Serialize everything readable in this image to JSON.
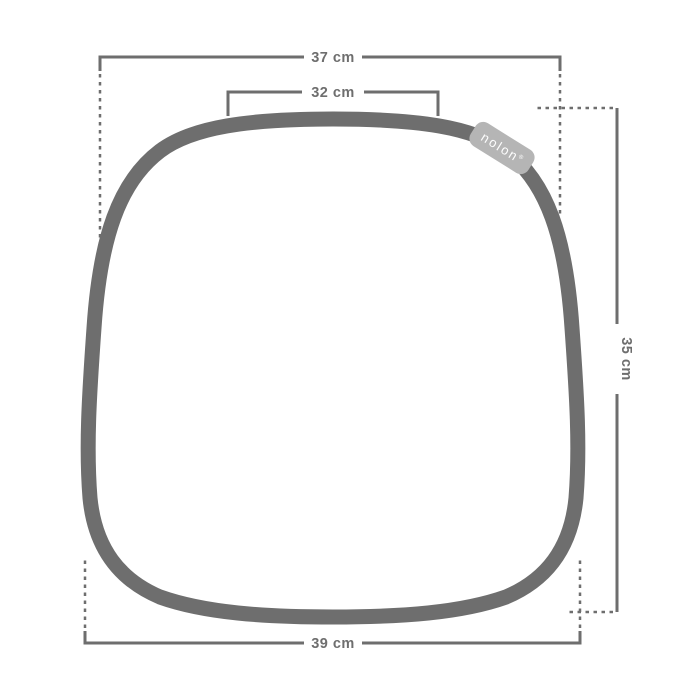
{
  "diagram": {
    "name": "seat-cushion-dimension-drawing",
    "brand_tag": {
      "label": "nolon",
      "registered_mark": "®"
    },
    "dimensions": {
      "top_outer": "37 cm",
      "top_inner": "32 cm",
      "side": "35 cm",
      "bottom": "39 cm"
    },
    "colors": {
      "line": "#6e6e6e",
      "tag_fill": "#b5b5b5",
      "tag_text": "#fdfdfd",
      "background": "#ffffff"
    }
  }
}
